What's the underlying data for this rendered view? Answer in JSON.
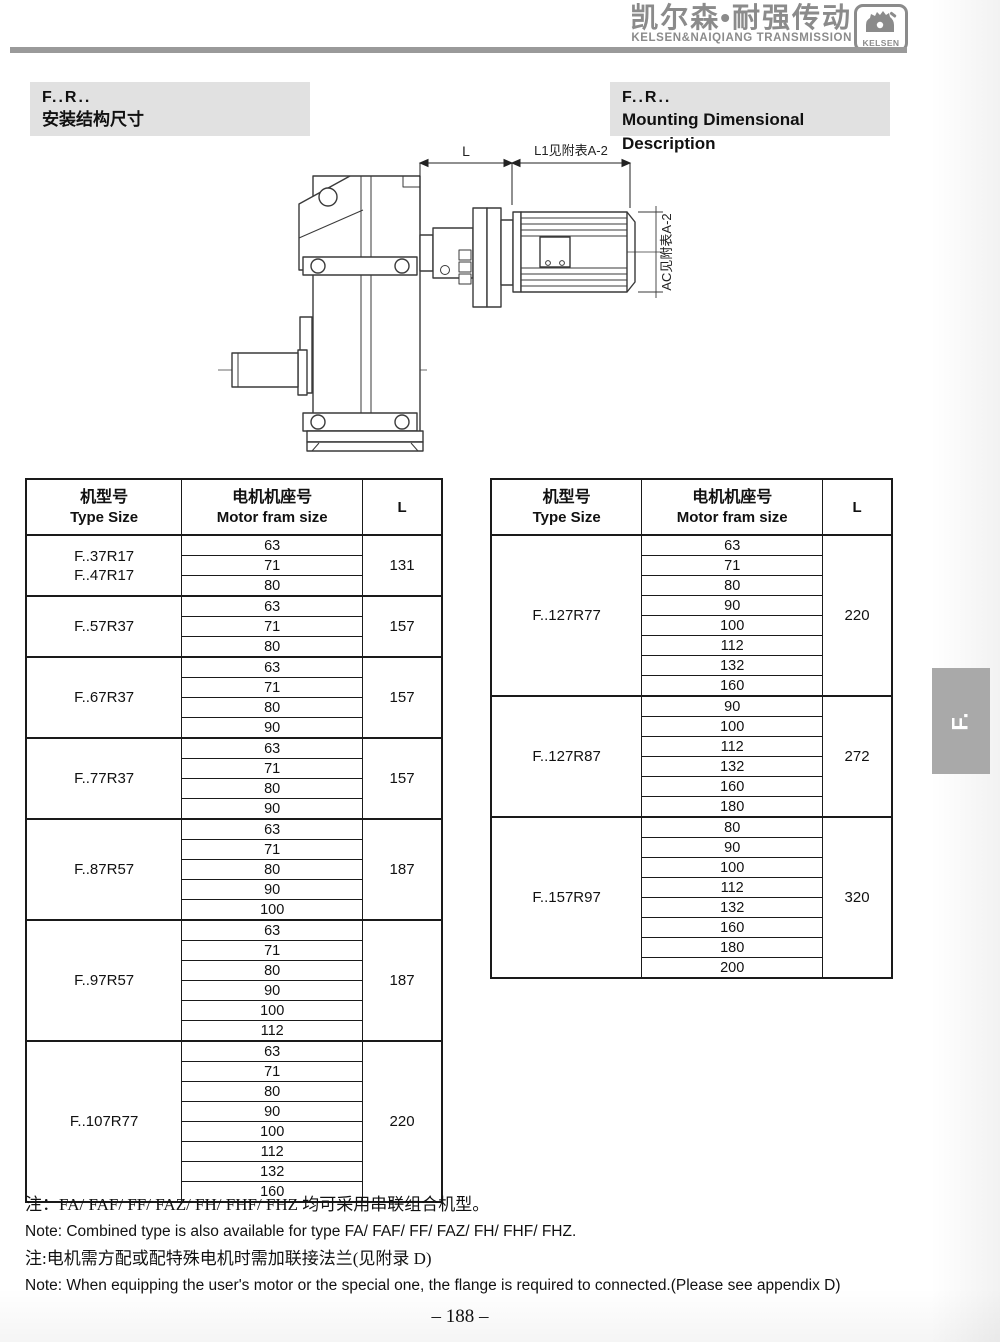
{
  "header": {
    "brand_cn": "凯尔森•耐强传动",
    "brand_en": "KELSEN&NAIQIANG TRANSMISSION",
    "logo_text": "KELSEN"
  },
  "titles": {
    "left": {
      "code": "F..R..",
      "subtitle": "安装结构尺寸"
    },
    "right": {
      "code": "F..R..",
      "subtitle": "Mounting Dimensional Description"
    }
  },
  "drawing_labels": {
    "dim_l": "L",
    "dim_l1": "L1见附表A-2",
    "dim_ac": "AC见附表A-2"
  },
  "table_header": {
    "col1_cn": "机型号",
    "col1_en": "Type Size",
    "col2_cn": "电机机座号",
    "col2_en": "Motor fram size",
    "col3": "L"
  },
  "tables": {
    "left": [
      {
        "type": [
          "F..37R17",
          "F..47R17"
        ],
        "frames": [
          "63",
          "71",
          "80"
        ],
        "L": "131"
      },
      {
        "type": [
          "F..57R37"
        ],
        "frames": [
          "63",
          "71",
          "80"
        ],
        "L": "157"
      },
      {
        "type": [
          "F..67R37"
        ],
        "frames": [
          "63",
          "71",
          "80",
          "90"
        ],
        "L": "157"
      },
      {
        "type": [
          "F..77R37"
        ],
        "frames": [
          "63",
          "71",
          "80",
          "90"
        ],
        "L": "157"
      },
      {
        "type": [
          "F..87R57"
        ],
        "frames": [
          "63",
          "71",
          "80",
          "90",
          "100"
        ],
        "L": "187"
      },
      {
        "type": [
          "F..97R57"
        ],
        "frames": [
          "63",
          "71",
          "80",
          "90",
          "100",
          "112"
        ],
        "L": "187"
      },
      {
        "type": [
          "F..107R77"
        ],
        "frames": [
          "63",
          "71",
          "80",
          "90",
          "100",
          "112",
          "132",
          "160"
        ],
        "L": "220"
      }
    ],
    "right": [
      {
        "type": [
          "F..127R77"
        ],
        "frames": [
          "63",
          "71",
          "80",
          "90",
          "100",
          "112",
          "132",
          "160"
        ],
        "L": "220"
      },
      {
        "type": [
          "F..127R87"
        ],
        "frames": [
          "90",
          "100",
          "112",
          "132",
          "160",
          "180"
        ],
        "L": "272"
      },
      {
        "type": [
          "F..157R97"
        ],
        "frames": [
          "80",
          "90",
          "100",
          "112",
          "132",
          "160",
          "180",
          "200"
        ],
        "L": "320"
      }
    ]
  },
  "notes": [
    "注：FA/ FAF/ FF/ FAZ/ FH/ FHF/ FHZ 均可采用串联组合机型。",
    "Note: Combined type is also available for type  FA/ FAF/ FF/ FAZ/ FH/ FHF/ FHZ.",
    "注:电机需方配或配特殊电机时需加联接法兰(见附录 D)",
    "Note: When equipping the user's motor or the special one, the flange is required to connected.(Please see appendix D)"
  ],
  "side_tab": "F.",
  "page_number": "– 188 –",
  "colors": {
    "brand_gray": "#8b8b8b",
    "title_bg": "#e1e1e1",
    "tab_bg": "#a9a9a9",
    "line": "#1a1a1a"
  }
}
